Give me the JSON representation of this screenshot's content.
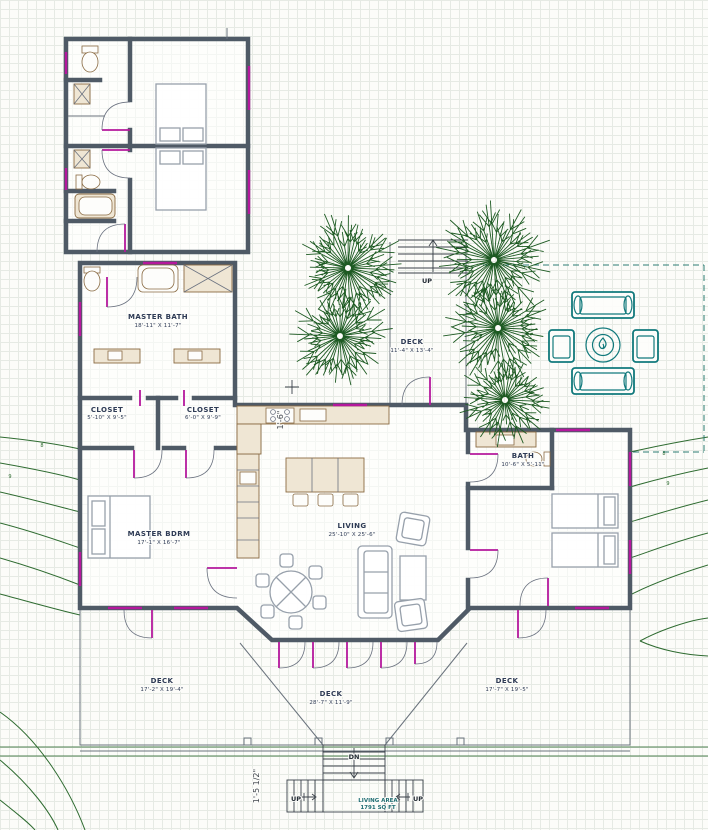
{
  "plan": {
    "rooms": {
      "master_bath": {
        "label": "MASTER BATH",
        "dims": "18'-11\" X 11'-7\""
      },
      "closet_left": {
        "label": "CLOSET",
        "dims": "5'-10\" X 9'-5\""
      },
      "closet_right": {
        "label": "CLOSET",
        "dims": "6'-0\" X 9'-9\""
      },
      "master_bdrm": {
        "label": "MASTER BDRM",
        "dims": "17'-1\" X 16'-7\""
      },
      "living": {
        "label": "LIVING",
        "dims": "25'-10\" X 25'-6\""
      },
      "bath": {
        "label": "BATH",
        "dims": "10'-6\" X 5'-11\""
      }
    },
    "decks": {
      "courtyard": {
        "label": "DECK",
        "dims": "11'-4\" X 13'-4\""
      },
      "left": {
        "label": "DECK",
        "dims": "17'-2\" X 19'-4\""
      },
      "center": {
        "label": "DECK",
        "dims": "28'-7\" X 11'-9\""
      },
      "right": {
        "label": "DECK",
        "dims": "17'-7\" X 19'-5\""
      }
    },
    "stairs": {
      "up_top": "UP",
      "down": "DN",
      "up_left": "UP",
      "up_right": "UP"
    },
    "area_note": {
      "line1": "LIVING AREA",
      "line2": "1791 SQ FT"
    },
    "dimensions": {
      "kitchen_offset": "1'-6\"",
      "stair_offset": "1'-5 1/2\""
    },
    "contour_labels": {
      "l1": "8",
      "l2": "9",
      "r1": "8",
      "r2": "9"
    }
  },
  "colors": {
    "wall": "#4f5a66",
    "door": "#b5189d",
    "tree": "#1d5a22",
    "contour": "#2e6b30",
    "outdoor": "#11797c",
    "label": "#2e3b55",
    "casework": "#8a6b43",
    "area_text": "#1f6d72"
  }
}
